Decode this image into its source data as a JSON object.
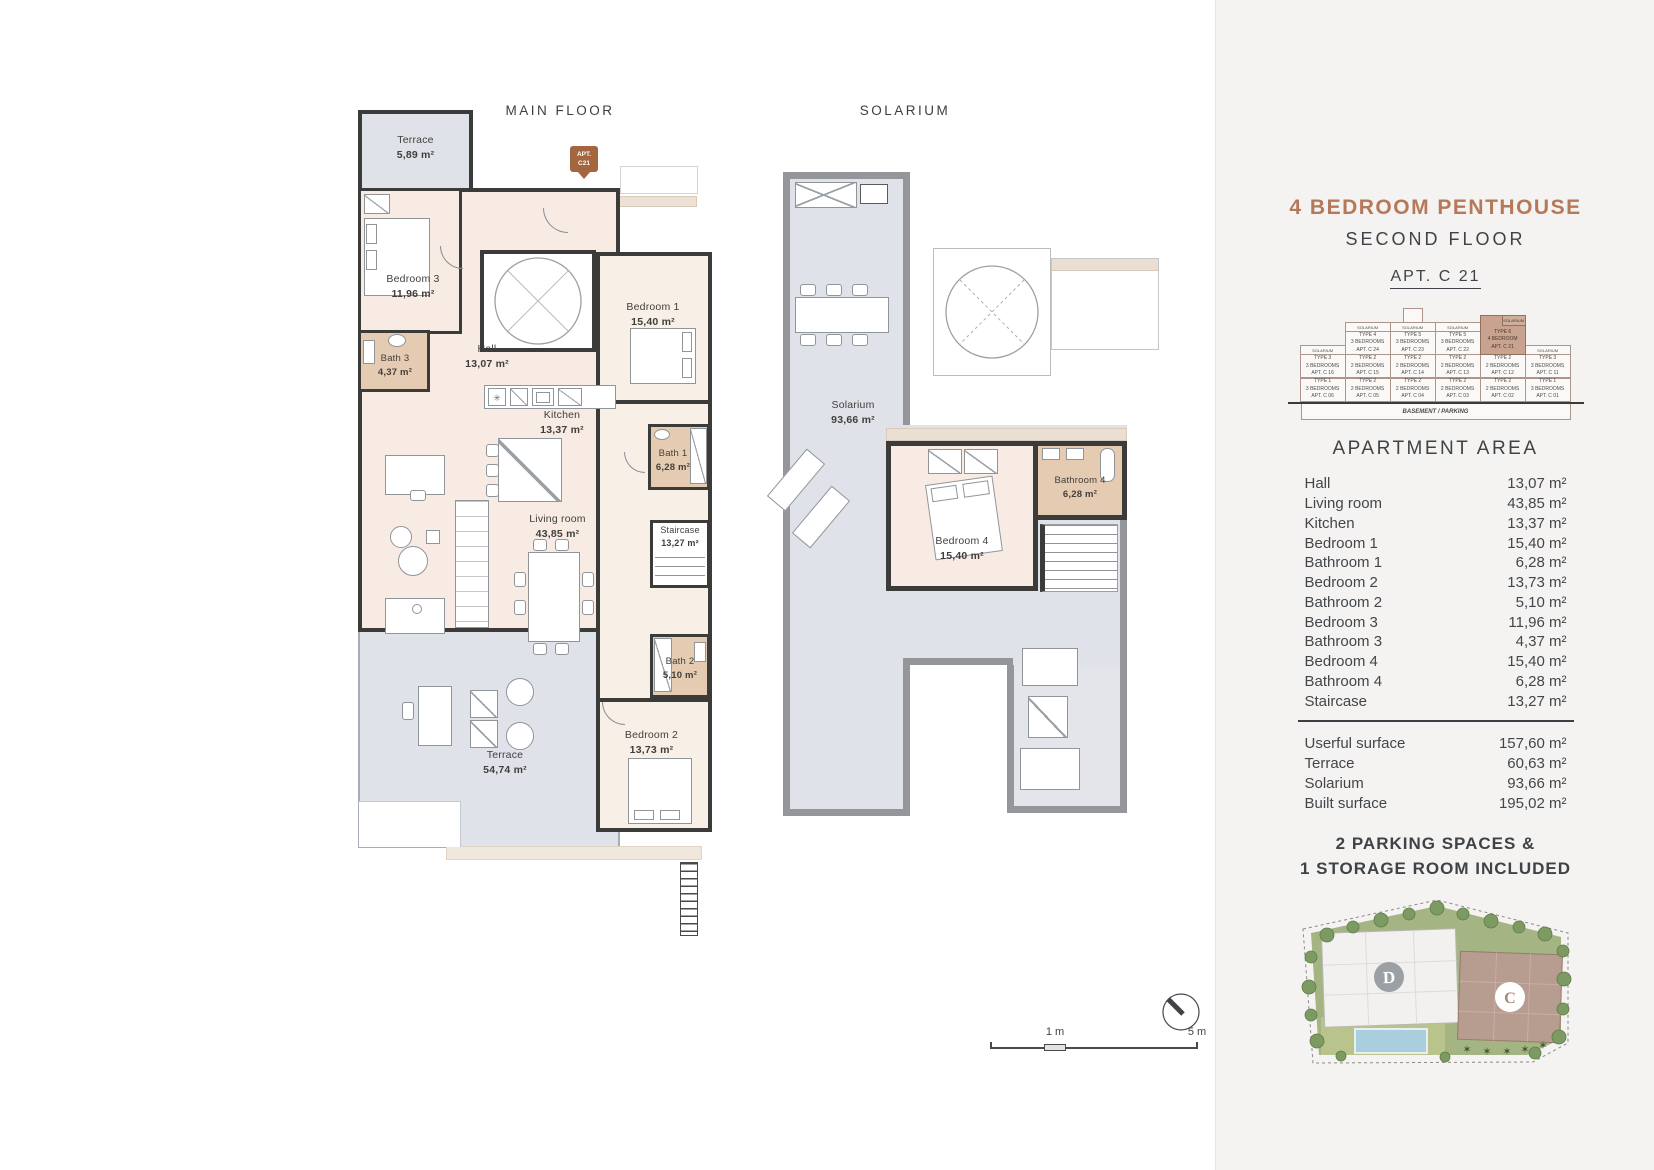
{
  "page": {
    "main_title": "MAIN FLOOR",
    "solarium_title": "SOLARIUM"
  },
  "marker": {
    "line1": "APT.",
    "line2": "C21"
  },
  "main_rooms": {
    "terrace_top": {
      "name": "Terrace",
      "area": "5,89 m²"
    },
    "bedroom3": {
      "name": "Bedroom 3",
      "area": "11,96 m²"
    },
    "bath3": {
      "name": "Bath 3",
      "area": "4,37 m²"
    },
    "hall": {
      "name": "Hall",
      "area": "13,07 m²"
    },
    "kitchen": {
      "name": "Kitchen",
      "area": "13,37 m²"
    },
    "bedroom1": {
      "name": "Bedroom 1",
      "area": "15,40 m²"
    },
    "bath1": {
      "name": "Bath 1",
      "area": "6,28 m²"
    },
    "staircase": {
      "name": "Staircase",
      "area": "13,27 m²"
    },
    "living": {
      "name": "Living room",
      "area": "43,85 m²"
    },
    "bath2": {
      "name": "Bath 2",
      "area": "5,10 m²"
    },
    "bedroom2": {
      "name": "Bedroom 2",
      "area": "13,73 m²"
    },
    "terrace_main": {
      "name": "Terrace",
      "area": "54,74 m²"
    }
  },
  "solarium_rooms": {
    "solarium": {
      "name": "Solarium",
      "area": "93,66 m²"
    },
    "bedroom4": {
      "name": "Bedroom 4",
      "area": "15,40 m²"
    },
    "bathroom4": {
      "name": "Bathroom 4",
      "area": "6,28 m²"
    }
  },
  "scale_bar": {
    "one": "1 m",
    "five": "5 m"
  },
  "sidebar": {
    "title": "4 BEDROOM PENTHOUSE",
    "subtitle": "SECOND FLOOR",
    "apt": "APT. C 21",
    "building": {
      "columns": [
        {
          "solarium": "SOLARIUM",
          "cells": [
            {
              "type": "TYPE 3",
              "beds": "3 BEDROOMS",
              "apt": "APT. C 16"
            },
            {
              "type": "TYPE 1",
              "beds": "3 BEDROOMS",
              "apt": "APT. C 06"
            }
          ]
        },
        {
          "solarium": "SOLARIUM",
          "cells": [
            {
              "type": "TYPE 4",
              "beds": "3 BEDROOMS",
              "apt": "APT. C 24"
            },
            {
              "type": "TYPE 2",
              "beds": "2 BEDROOMS",
              "apt": "APT. C 15"
            },
            {
              "type": "TYPE 2",
              "beds": "2 BEDROOMS",
              "apt": "APT. C 05"
            }
          ]
        },
        {
          "solarium": "SOLARIUM",
          "cells": [
            {
              "type": "TYPE 5",
              "beds": "3 BEDROOMS",
              "apt": "APT. C 23"
            },
            {
              "type": "TYPE 2",
              "beds": "2 BEDROOMS",
              "apt": "APT. C 14"
            },
            {
              "type": "TYPE 2",
              "beds": "2 BEDROOMS",
              "apt": "APT. C 04"
            }
          ]
        },
        {
          "solarium": "SOLARIUM",
          "cells": [
            {
              "type": "TYPE 5",
              "beds": "3 BEDROOMS",
              "apt": "APT. C 22"
            },
            {
              "type": "TYPE 2",
              "beds": "2 BEDROOMS",
              "apt": "APT. C 13"
            },
            {
              "type": "TYPE 2",
              "beds": "2 BEDROOMS",
              "apt": "APT. C 03"
            }
          ]
        },
        {
          "solarium": "SOLARIUM",
          "highlight": true,
          "cells": [
            {
              "type": "TYPE 6",
              "beds": "4 BEDROOM",
              "apt": "APT. C 21"
            },
            {
              "type": "TYPE 2",
              "beds": "2 BEDROOMS",
              "apt": "APT. C 12"
            },
            {
              "type": "TYPE 2",
              "beds": "2 BEDROOMS",
              "apt": "APT. C 02"
            }
          ]
        },
        {
          "solarium": "SOLARIUM",
          "cells": [
            {
              "type": "TYPE 3",
              "beds": "3 BEDROOMS",
              "apt": "APT. C 11"
            },
            {
              "type": "TYPE 1",
              "beds": "3 BEDROOMS",
              "apt": "APT. C 01"
            }
          ]
        }
      ],
      "basement": "BASEMENT / PARKING"
    },
    "area_heading": "APARTMENT AREA",
    "rows": [
      {
        "label": "Hall",
        "value": "13,07 m²"
      },
      {
        "label": "Living room",
        "value": "43,85 m²"
      },
      {
        "label": "Kitchen",
        "value": "13,37 m²"
      },
      {
        "label": "Bedroom 1",
        "value": "15,40 m²"
      },
      {
        "label": "Bathroom 1",
        "value": "6,28 m²"
      },
      {
        "label": "Bedroom 2",
        "value": "13,73 m²"
      },
      {
        "label": "Bathroom 2",
        "value": "5,10 m²"
      },
      {
        "label": "Bedroom 3",
        "value": "11,96 m²"
      },
      {
        "label": "Bathroom 3",
        "value": "4,37 m²"
      },
      {
        "label": "Bedroom 4",
        "value": "15,40 m²"
      },
      {
        "label": "Bathroom 4",
        "value": "6,28 m²"
      },
      {
        "label": "Staircase",
        "value": "13,27 m²"
      }
    ],
    "totals": [
      {
        "label": "Userful surface",
        "value": "157,60 m²"
      },
      {
        "label": "Terrace",
        "value": "60,63 m²"
      },
      {
        "label": "Solarium",
        "value": "93,66 m²"
      },
      {
        "label": "Built surface",
        "value": "195,02 m²"
      }
    ],
    "parking": {
      "line1": "2 PARKING SPACES &",
      "line2": "1 STORAGE ROOM INCLUDED"
    },
    "sitemap": {
      "building_d": "D",
      "building_c": "C"
    }
  },
  "colors": {
    "accent_brown": "#b5795a",
    "wall_dark": "#3b3b3a",
    "terrace_fill": "#dfe2e8",
    "interior_fill": "#f7ebe3",
    "bath_fill": "#e6cbb3",
    "solarium_wall": "#95969a",
    "highlight_cell": "#c9a38f"
  }
}
